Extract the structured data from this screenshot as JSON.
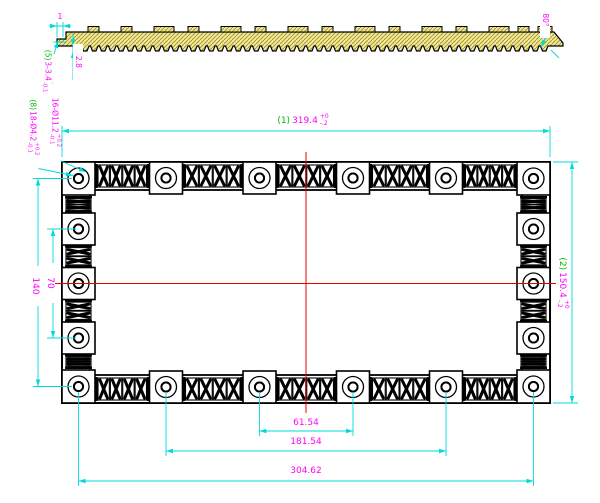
{
  "colors": {
    "dimension_line": "#00d9d9",
    "dimension_text": "#ff00ff",
    "reference_text": "#00b800",
    "centerline": "#e60000",
    "section_fill": "#f0e68c",
    "geometry": "#000000"
  },
  "section_view": {
    "end_dim": "1",
    "thickness_dim": "2.8",
    "chamfer_angle": "80°"
  },
  "callouts": {
    "slot": {
      "ref": "(5)",
      "text": "3-3.4",
      "tol_plus": "+0.2",
      "tol_minus": "-0.1"
    },
    "counterbore": {
      "text": "16-Ø11.2",
      "tol_plus": "+0.2",
      "tol_minus": "-0.1"
    },
    "through_hole": {
      "ref": "(8)",
      "text": "18-Ø4.2",
      "tol_plus": "+0.2",
      "tol_minus": "-0.1"
    }
  },
  "dimensions": {
    "overall_width": {
      "ref": "(1)",
      "value": "319.4",
      "tol_plus": "+0",
      "tol_minus": "-.2"
    },
    "overall_height": {
      "ref": "(2)",
      "value": "150.4",
      "tol_plus": "+0",
      "tol_minus": "-.2"
    },
    "side_hole_spacing": "70",
    "side_hole_span": "140",
    "bottom_hole_spacing": "61.54",
    "bottom_hole_span_inner": "181.54",
    "bottom_hole_span_outer": "304.62"
  }
}
